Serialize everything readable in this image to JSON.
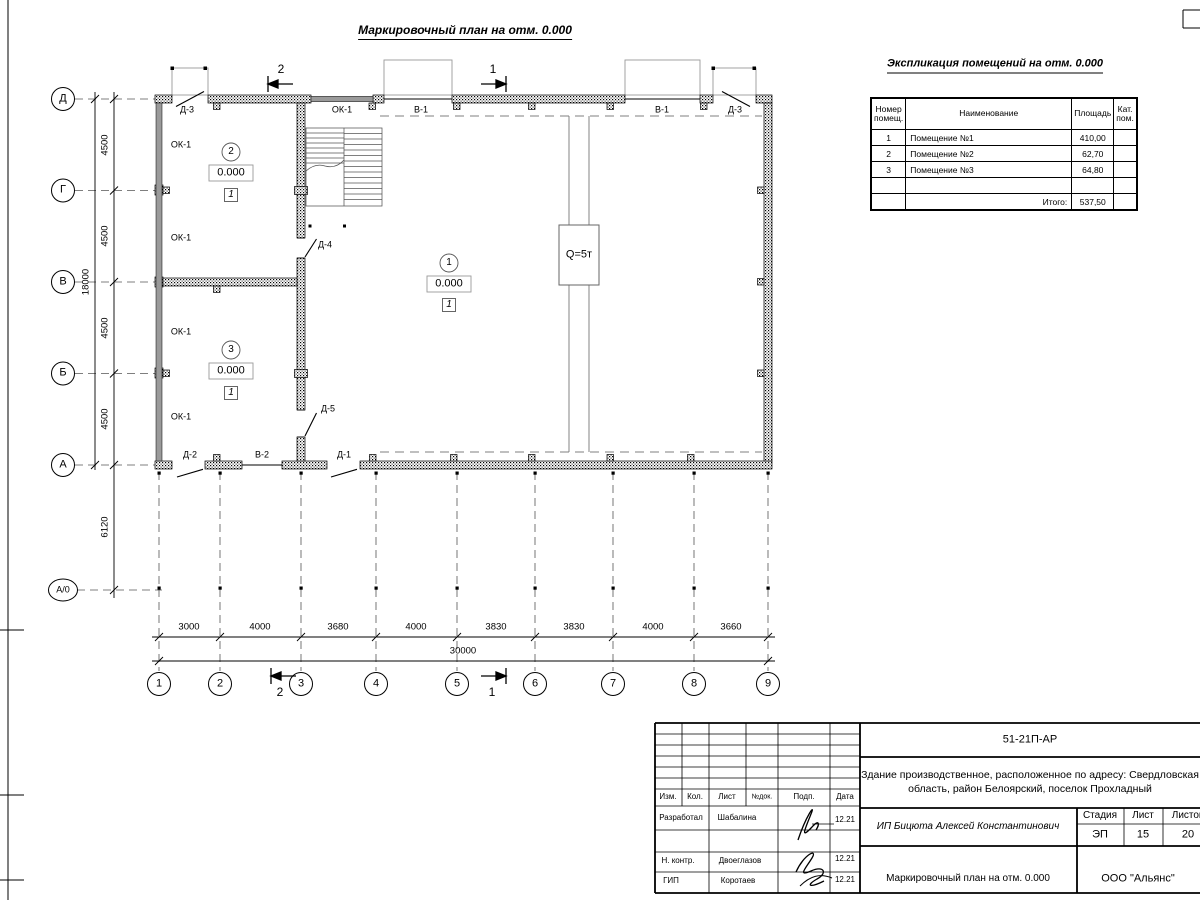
{
  "sheet": {
    "main_title": "Маркировочный план на отм. 0.000",
    "explication_title": "Экспликация помещений на отм. 0.000"
  },
  "explication": {
    "col_num": "Номер помещ.",
    "col_name": "Наименование",
    "col_area": "Площадь",
    "col_cat": "Кат. пом.",
    "rows": [
      {
        "num": "1",
        "name": "Помещение №1",
        "area": "410,00",
        "cat": ""
      },
      {
        "num": "2",
        "name": "Помещение №2",
        "area": "62,70",
        "cat": ""
      },
      {
        "num": "3",
        "name": "Помещение №3",
        "area": "64,80",
        "cat": ""
      }
    ],
    "total_label": "Итого:",
    "total_area": "537,50"
  },
  "plan": {
    "rooms": [
      {
        "num": "1",
        "elevation": "0.000",
        "finish": "1"
      },
      {
        "num": "2",
        "elevation": "0.000",
        "finish": "1"
      },
      {
        "num": "3",
        "elevation": "0.000",
        "finish": "1"
      }
    ],
    "crane": "Q=5т",
    "labels": {
      "ok1": "ОК-1",
      "v1": "В-1",
      "v2": "В-2",
      "d1": "Д-1",
      "d2": "Д-2",
      "d3": "Д-3",
      "d4": "Д-4",
      "d5": "Д-5"
    },
    "sections": {
      "s1": "1",
      "s2": "2"
    }
  },
  "grid": {
    "cols": [
      "1",
      "2",
      "3",
      "4",
      "5",
      "6",
      "7",
      "8",
      "9"
    ],
    "rows": [
      "Д",
      "Г",
      "В",
      "Б",
      "А",
      "А/0"
    ],
    "col_dims": [
      "3000",
      "4000",
      "3680",
      "4000",
      "3830",
      "3830",
      "4000",
      "3660"
    ],
    "row_dims": [
      "4500",
      "4500",
      "4500",
      "4500"
    ],
    "total_col": "30000",
    "total_row": "18000",
    "apron": "6120"
  },
  "title_block": {
    "doc": "51-21П-АР",
    "project": "Здание производственное, расположенное по адресу: Свердловская область, район Белоярский, поселок Прохладный",
    "designer": "ИП Бицюта Алексей Константинович",
    "drawing_title": "Маркировочный план на отм. 0.000",
    "company": "ООО \"Альянс\"",
    "stage_label": "Стадия",
    "list_label": "Лист",
    "lists_label": "Листов",
    "stage": "ЭП",
    "list": "15",
    "lists": "20",
    "head": {
      "izm": "Изм.",
      "kol": "Кол.",
      "list": "Лист",
      "ndok": "№док.",
      "podp": "Подп.",
      "data": "Дата"
    },
    "signers": [
      {
        "role": "Разработал",
        "name": "Шабалина",
        "date": "12.21"
      },
      {
        "role": "Н. контр.",
        "name": "Двоеглазов",
        "date": "12.21"
      },
      {
        "role": "ГИП",
        "name": "Коротаев",
        "date": "12.21"
      }
    ]
  }
}
